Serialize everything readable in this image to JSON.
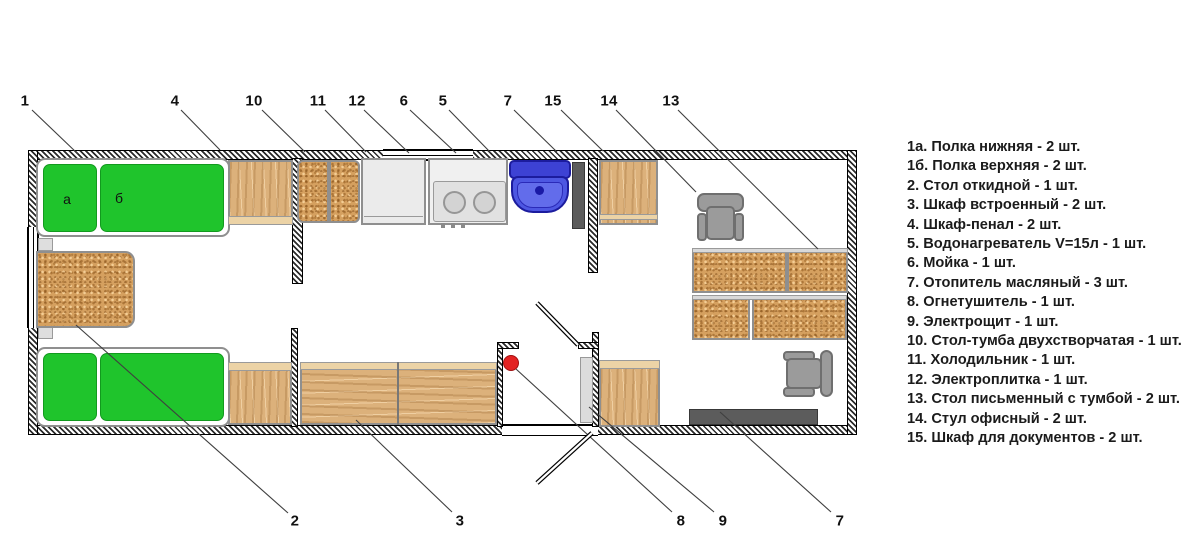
{
  "legend": {
    "items": [
      "1а. Полка нижняя - 2 шт.",
      "1б. Полка верхняя - 2 шт.",
      "2. Стол откидной - 1 шт.",
      "3. Шкаф встроенный - 2 шт.",
      "4. Шкаф-пенал - 2 шт.",
      "5. Водонагреватель V=15л - 1 шт.",
      "6. Мойка - 1 шт.",
      "7. Отопитель масляный - 3 шт.",
      "8. Огнетушитель - 1 шт.",
      "9. Электрощит - 1 шт.",
      "10. Стол-тумба двухстворчатая - 1 шт.",
      "11. Холодильник - 1 шт.",
      "12. Электроплитка - 1 шт.",
      "13. Стол письменный с тумбой - 2 шт.",
      "14. Стул офисный - 2 шт.",
      "15. Шкаф для документов - 2 шт."
    ]
  },
  "plan": {
    "shelf_label_a": "а",
    "shelf_label_b": "б"
  },
  "callouts": {
    "top": [
      {
        "label": "1",
        "x": 25,
        "y": 101,
        "line": [
          32,
          110,
          78,
          154
        ]
      },
      {
        "label": "4",
        "x": 175,
        "y": 101,
        "line": [
          181,
          110,
          220,
          150
        ]
      },
      {
        "label": "10",
        "x": 254,
        "y": 101,
        "line": [
          262,
          110,
          305,
          152
        ]
      },
      {
        "label": "11",
        "x": 318,
        "y": 101,
        "line": [
          325,
          110,
          366,
          152
        ]
      },
      {
        "label": "12",
        "x": 357,
        "y": 101,
        "line": [
          364,
          110,
          409,
          153
        ]
      },
      {
        "label": "6",
        "x": 404,
        "y": 101,
        "line": [
          410,
          110,
          456,
          153
        ]
      },
      {
        "label": "5",
        "x": 443,
        "y": 101,
        "line": [
          449,
          110,
          491,
          153
        ]
      },
      {
        "label": "7",
        "x": 508,
        "y": 101,
        "line": [
          514,
          110,
          557,
          152
        ]
      },
      {
        "label": "15",
        "x": 553,
        "y": 101,
        "line": [
          561,
          110,
          603,
          151
        ]
      },
      {
        "label": "14",
        "x": 609,
        "y": 101,
        "line": [
          616,
          110,
          696,
          192
        ]
      },
      {
        "label": "13",
        "x": 671,
        "y": 101,
        "line": [
          678,
          110,
          818,
          249
        ]
      }
    ],
    "bottom": [
      {
        "label": "2",
        "x": 295,
        "y": 521,
        "line": [
          76,
          325,
          288,
          513
        ]
      },
      {
        "label": "3",
        "x": 460,
        "y": 521,
        "line": [
          356,
          420,
          452,
          512
        ]
      },
      {
        "label": "8",
        "x": 681,
        "y": 521,
        "line": [
          516,
          369,
          672,
          512
        ]
      },
      {
        "label": "9",
        "x": 723,
        "y": 521,
        "line": [
          589,
          407,
          714,
          512
        ]
      },
      {
        "label": "7",
        "x": 840,
        "y": 521,
        "line": [
          720,
          412,
          831,
          512
        ]
      }
    ]
  },
  "doors": [
    {
      "x1": 578,
      "y1": 345,
      "x2": 537,
      "y2": 303
    },
    {
      "x1": 592,
      "y1": 433,
      "x2": 537,
      "y2": 483
    }
  ],
  "colors": {
    "green": "#1fc42c",
    "cork": "#d5a05f",
    "wood": "#dcb17b",
    "sink-blue": "#4d57e2",
    "heater": "#5c5c5c",
    "red": "#e32222"
  }
}
